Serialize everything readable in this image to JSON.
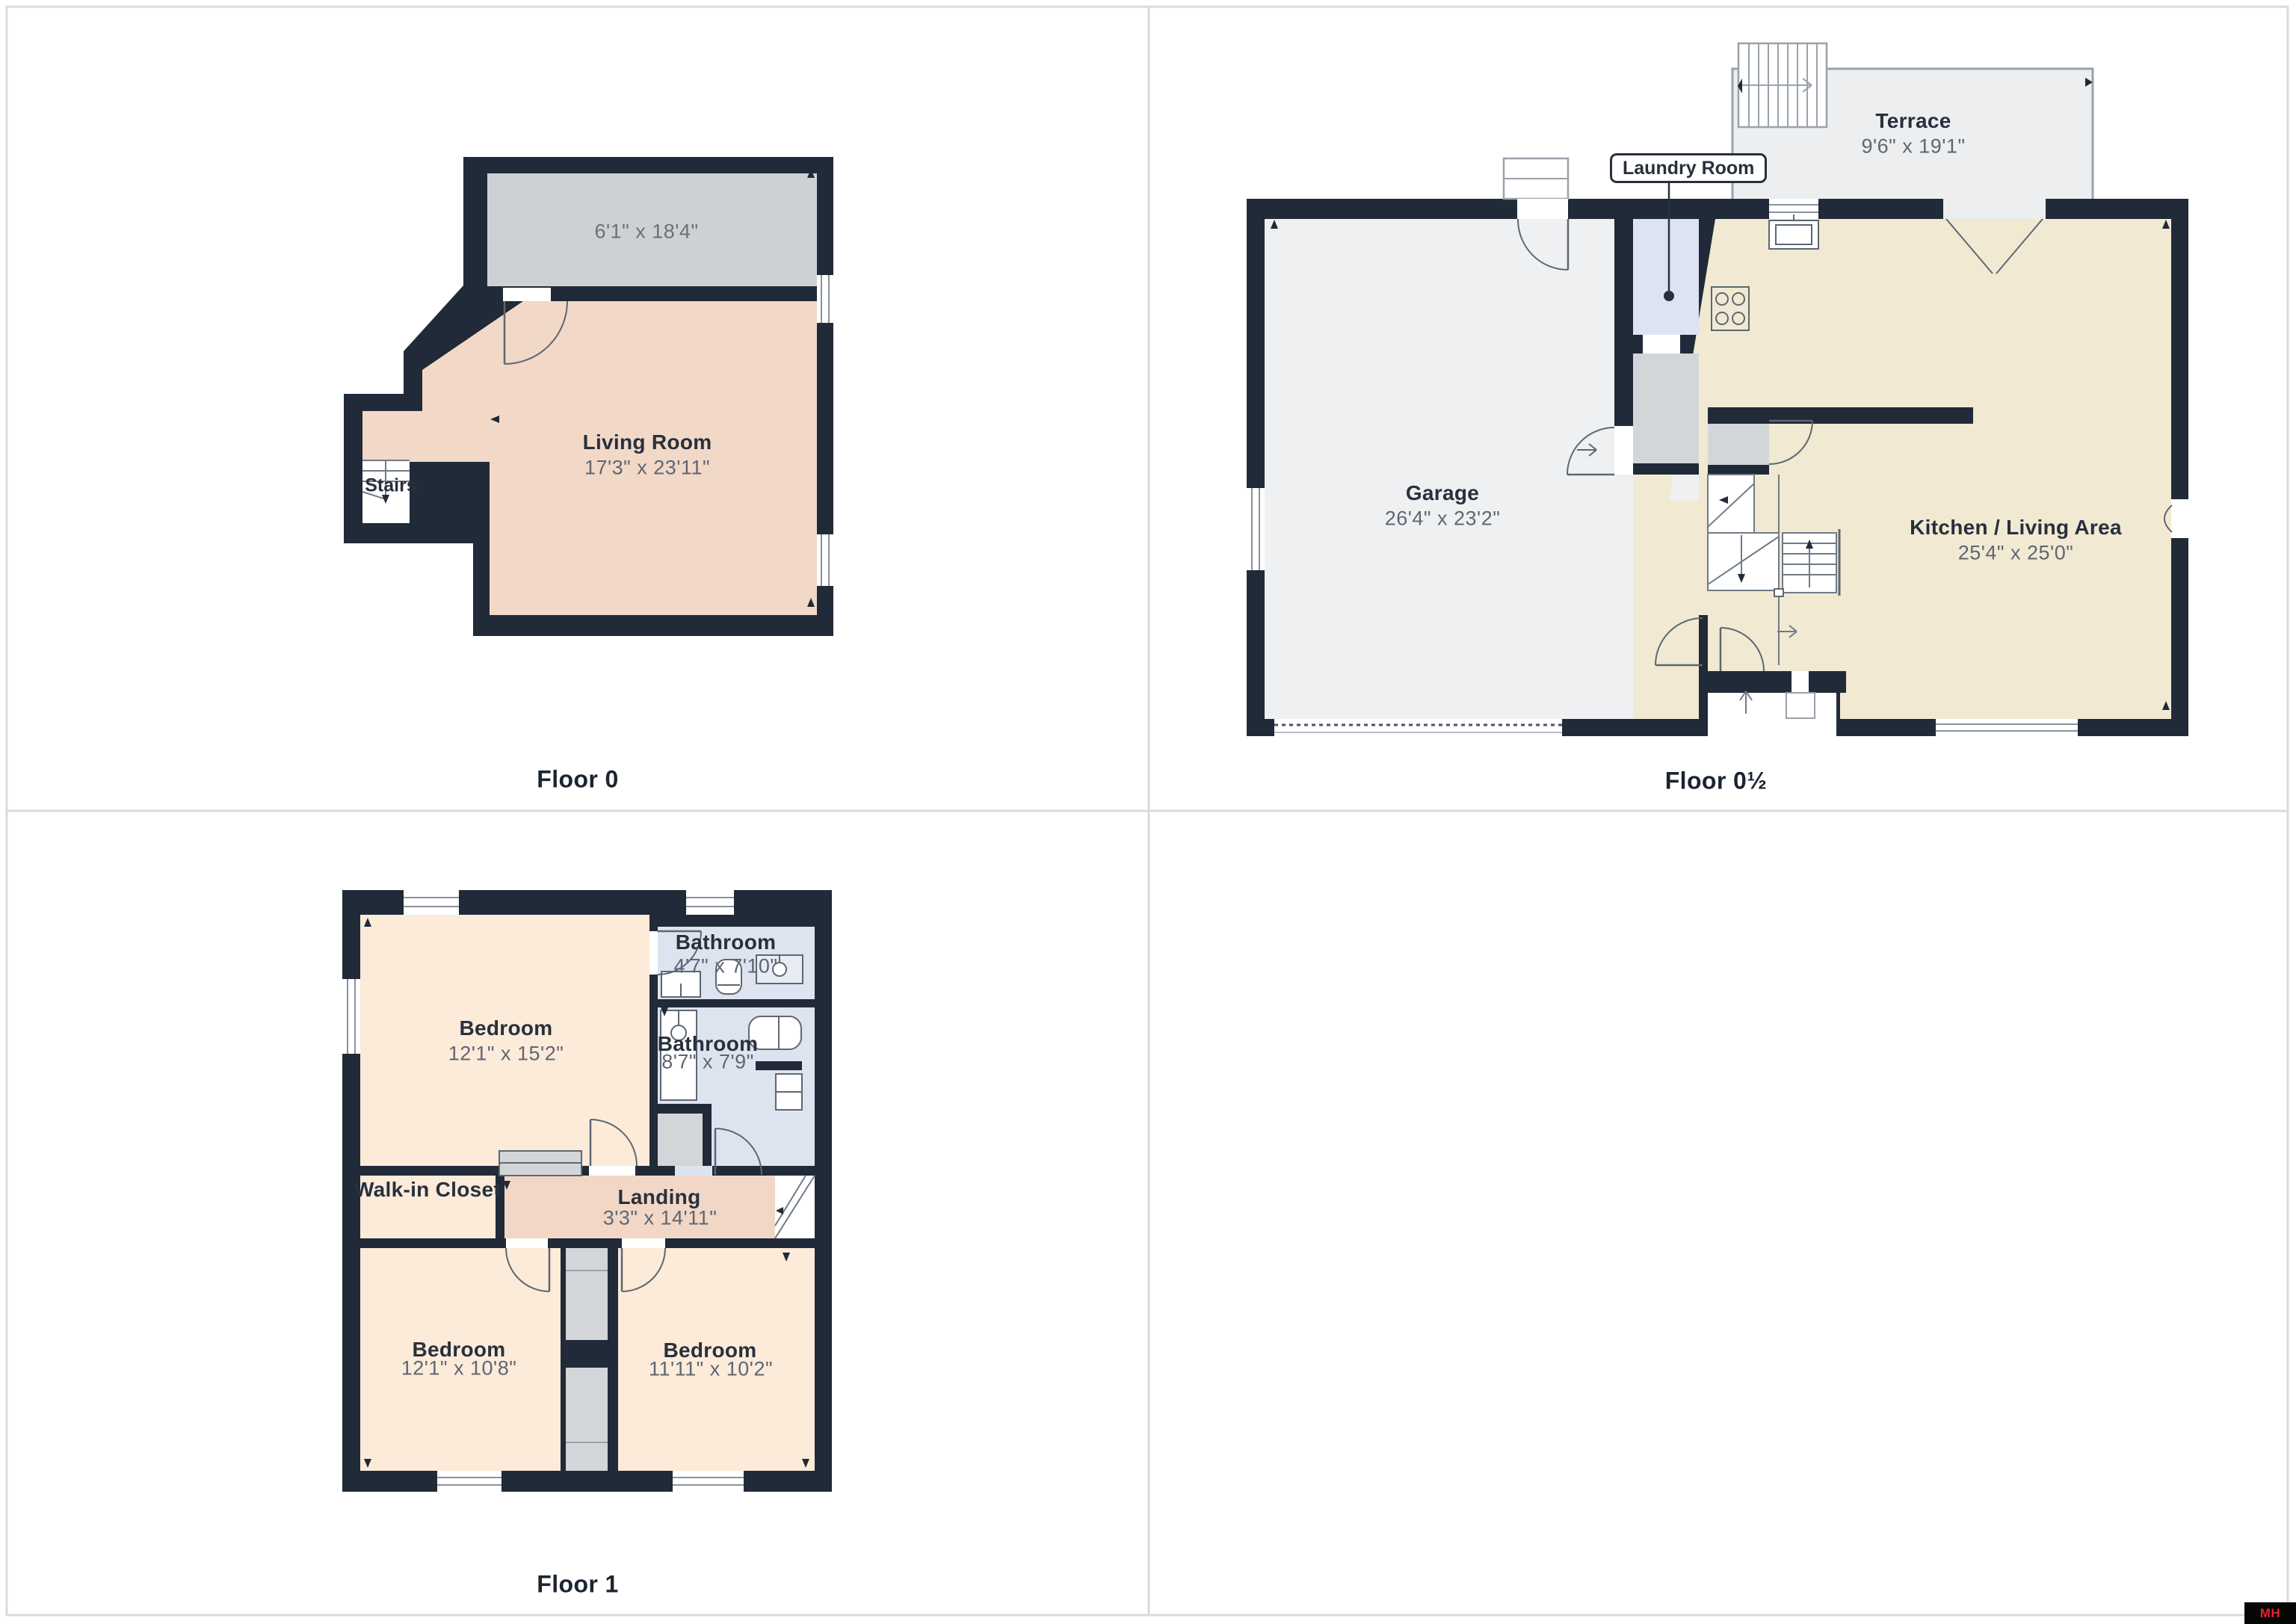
{
  "page": {
    "background": "#ffffff",
    "frame_color": "#d9dbdd"
  },
  "palette": {
    "wall": "#202a38",
    "living_room_floor": "#f2d8c7",
    "gray_room_floor": "#ced1d4",
    "garage_floor": "#eff0f2",
    "kitchen_floor": "#f1e9d2",
    "laundry_floor": "#dde3f2",
    "bathroom_floor": "#dde3ef",
    "bedroom_floor": "#fcebd9",
    "landing_floor": "#f2d7c6",
    "terrace_floor": "#eceef0",
    "closet_gray": "#d3d6d9",
    "logo_bg": "#060606",
    "logo_red": "#e8212e"
  },
  "floors": [
    {
      "title": "Floor 0",
      "rooms": [
        {
          "name": "",
          "dims": "6'1\" x 18'4\""
        },
        {
          "name": "Living Room",
          "dims": "17'3\" x 23'11\""
        },
        {
          "name": "Stairs",
          "dims": ""
        }
      ]
    },
    {
      "title": "Floor 0½",
      "rooms": [
        {
          "name": "Terrace",
          "dims": "9'6\" x 19'1\""
        },
        {
          "name": "Garage",
          "dims": "26'4\" x 23'2\""
        },
        {
          "name": "Kitchen / Living Area",
          "dims": "25'4\" x 25'0\""
        },
        {
          "name": "Laundry Room",
          "dims": ""
        }
      ]
    },
    {
      "title": "Floor 1",
      "rooms": [
        {
          "name": "Bedroom",
          "dims": "12'1\" x 15'2\""
        },
        {
          "name": "Bathroom",
          "dims": "4'7\" x 7'10\""
        },
        {
          "name": "Bathroom",
          "dims": "8'7\" x 7'9\""
        },
        {
          "name": "Walk-in Closet",
          "dims": ""
        },
        {
          "name": "Landing",
          "dims": "3'3\" x 14'11\""
        },
        {
          "name": "Bedroom",
          "dims": "12'1\" x 10'8\""
        },
        {
          "name": "Bedroom",
          "dims": "11'11\" x 10'2\""
        }
      ]
    }
  ],
  "branding": {
    "logo_text": "MH MLS"
  }
}
